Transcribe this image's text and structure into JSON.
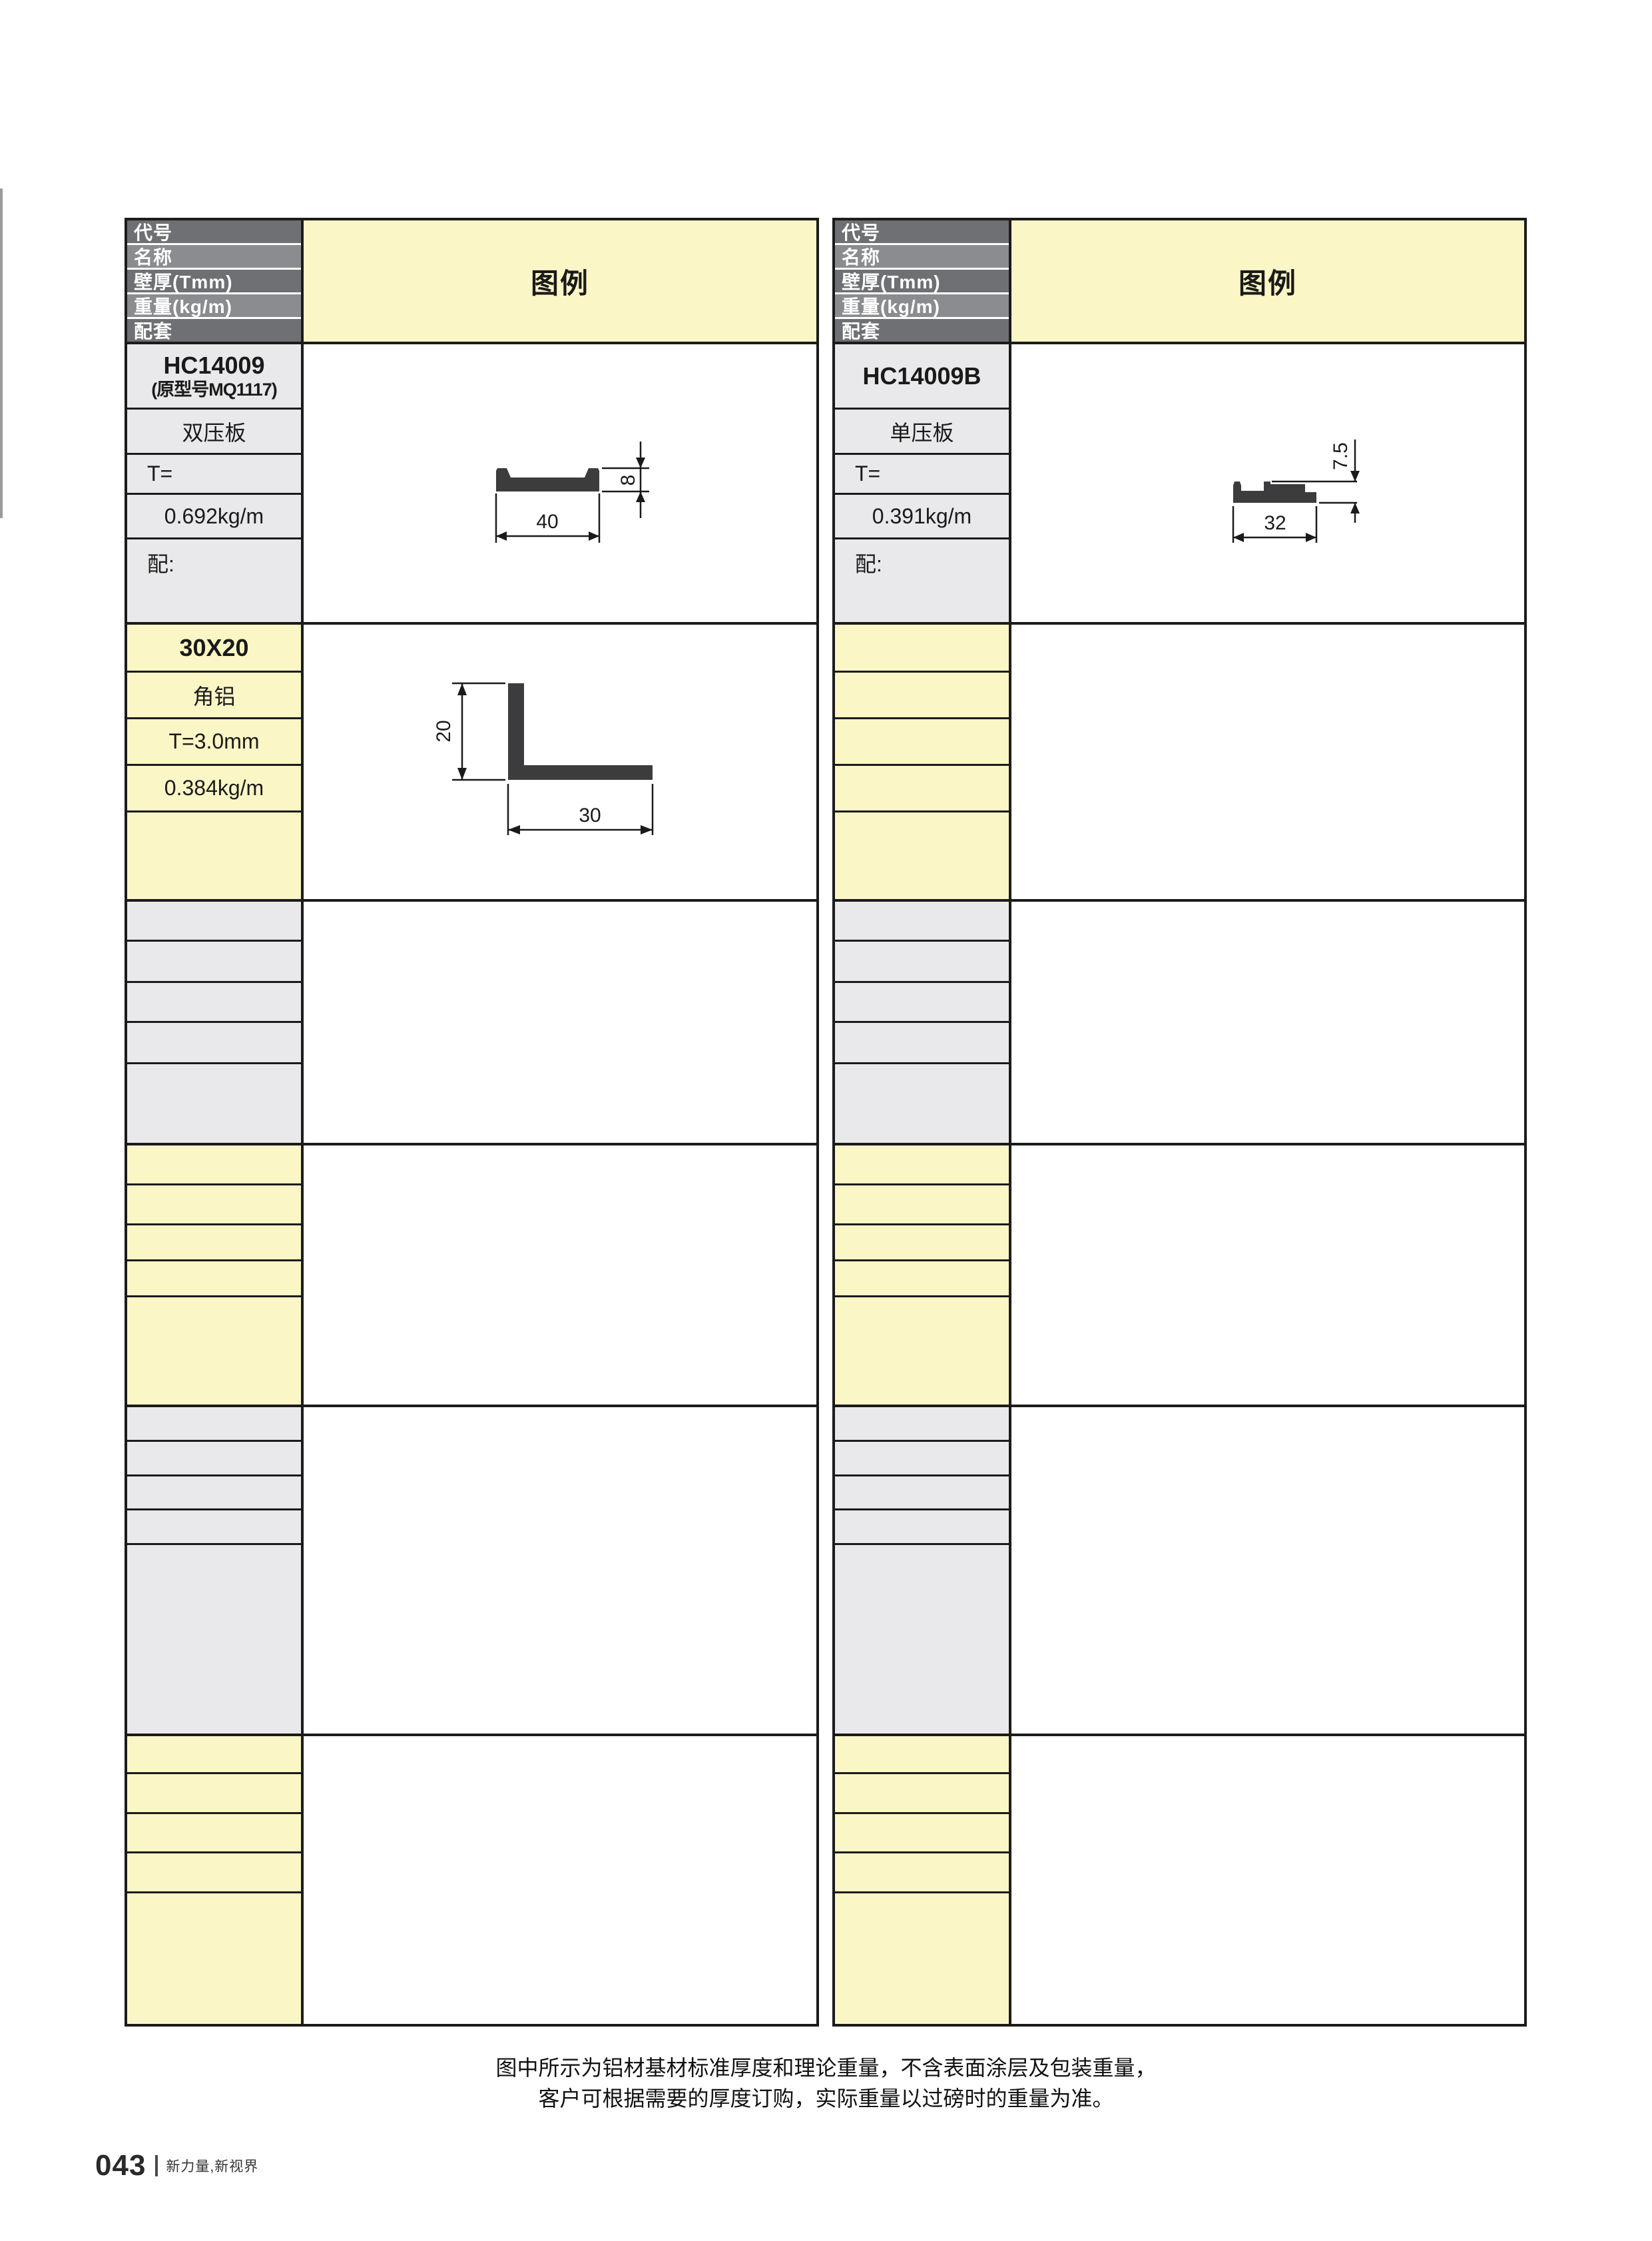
{
  "tables": {
    "header_labels": [
      "代号",
      "名称",
      "壁厚(Tmm)",
      "重量(kg/m)",
      "配套"
    ],
    "legend_title": "图例",
    "left": {
      "block1": {
        "code": "HC14009",
        "code_note": "(原型号MQ1117)",
        "name": "双压板",
        "thickness": "T=",
        "weight": "0.692kg/m",
        "match": "配:",
        "drawing": {
          "width_label": "40",
          "height_label": "8"
        }
      },
      "block2": {
        "code": "30X20",
        "name": "角铝",
        "thickness": "T=3.0mm",
        "weight": "0.384kg/m",
        "drawing": {
          "width_label": "30",
          "height_label": "20"
        }
      }
    },
    "right": {
      "block1": {
        "code": "HC14009B",
        "name": "单压板",
        "thickness": "T=",
        "weight": "0.391kg/m",
        "match": "配:",
        "drawing": {
          "width_label": "32",
          "height_label": "7.5"
        }
      }
    }
  },
  "footer": {
    "note_line1": "图中所示为铝材基材标准厚度和理论重量，不含表面涂层及包装重量，",
    "note_line2": "客户可根据需要的厚度订购，实际重量以过磅时的重量为准。",
    "page_number": "043",
    "slogan": "新力量,新视界"
  },
  "colors": {
    "cell_yellow": "#fbf6c5",
    "cell_gray": "#e9e8ea",
    "header_dark_gray": "#6f7073",
    "header_light_gray": "#8b8c8f",
    "border_black": "#1b1b1b",
    "profile_fill": "#3c3c3e"
  }
}
